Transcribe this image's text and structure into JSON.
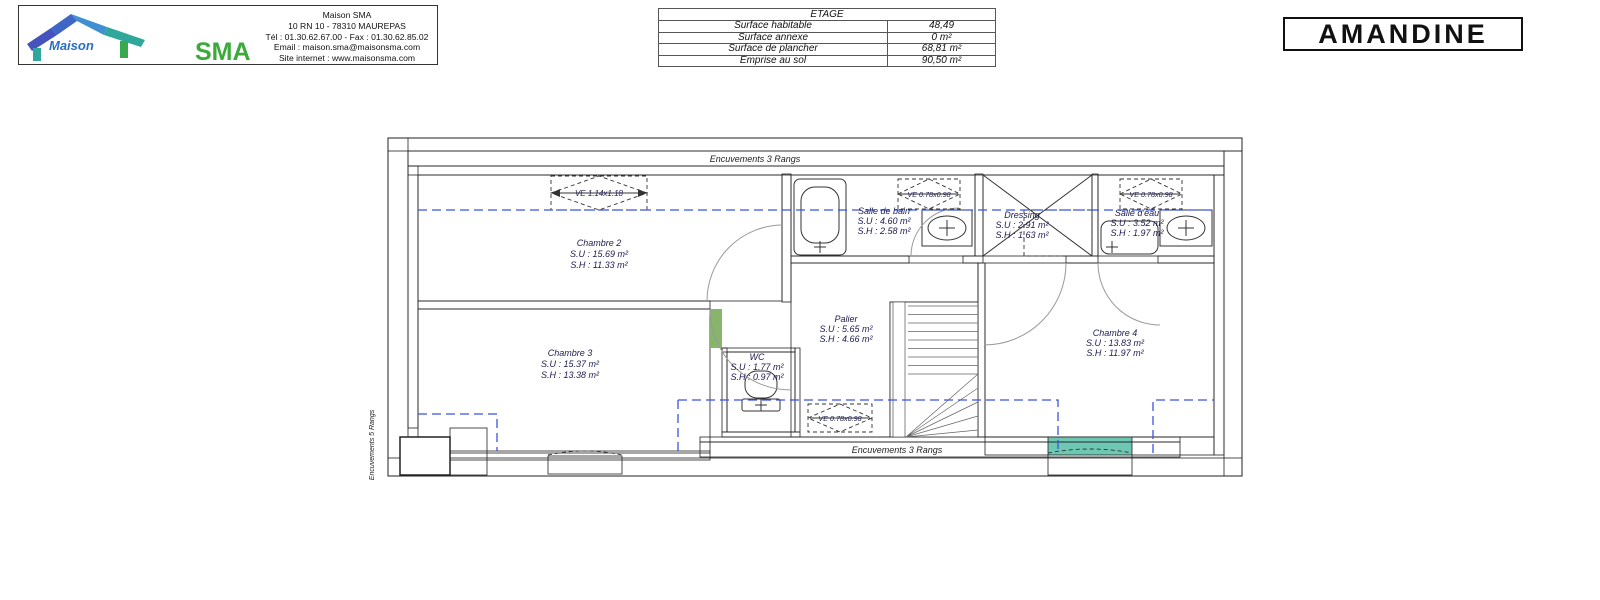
{
  "header": {
    "logo": {
      "brand_maison": "Maison",
      "brand_sma": "SMA",
      "company": "Maison SMA",
      "address": "10 RN 10 - 78310 MAUREPAS",
      "phone": "Tél : 01.30.62.67.00 - Fax : 01.30.62.85.02",
      "email": "Email : maison.sma@maisonsma.com",
      "website": "Site internet : www.maisonsma.com"
    },
    "surface_table": {
      "title": "ETAGE",
      "rows": [
        {
          "label": "Surface habitable",
          "value": "48,49"
        },
        {
          "label": "Surface annexe",
          "value": "0 m²"
        },
        {
          "label": "Surface de plancher",
          "value": "68,81 m²"
        },
        {
          "label": "Emprise au sol",
          "value": "90,50 m²"
        }
      ]
    },
    "project_title": "AMANDINE"
  },
  "plan": {
    "annotations": {
      "top_band": "Encuvements 3 Rangs",
      "bottom_band": "Encuvements 3 Rangs",
      "left_band": "Encuvements 5 Rangs"
    },
    "rooms": [
      {
        "name": "Chambre 2",
        "su": "S.U : 15.69 m²",
        "sh": "S.H : 11.33 m²",
        "color": "#80ef80"
      },
      {
        "name": "Chambre 3",
        "su": "S.U : 15.37 m²",
        "sh": "S.H : 13.38 m²",
        "color": "#86b56b"
      },
      {
        "name": "Salle de bain",
        "su": "S.U : 4.60 m²",
        "sh": "S.H : 2.58 m²",
        "color": "#7173d4"
      },
      {
        "name": "Dressing",
        "su": "S.U : 2.91 m²",
        "sh": "S.H : 1.63 m²",
        "color": "#f5a470"
      },
      {
        "name": "Salle d'eau",
        "su": "S.U : 3.52 m²",
        "sh": "S.H : 1.97 m²",
        "color": "#62aef0"
      },
      {
        "name": "Palier",
        "su": "S.U : 5.65 m²",
        "sh": "S.H : 4.66 m²",
        "color": "#e08ae8"
      },
      {
        "name": "WC",
        "su": "S.U : 1.77 m²",
        "sh": "S.H : 0.97 m²",
        "color": "#76dbe8"
      },
      {
        "name": "Chambre 4",
        "su": "S.U : 13.83 m²",
        "sh": "S.H : 11.97 m²",
        "color": "#6ec7b2"
      }
    ],
    "roof_windows": [
      {
        "label": "VE 1.14x1.18"
      },
      {
        "label": "VE 0.78x0.98"
      },
      {
        "label": "VE 0.78x0.98"
      },
      {
        "label": "VE 0.78x0.98"
      }
    ]
  }
}
